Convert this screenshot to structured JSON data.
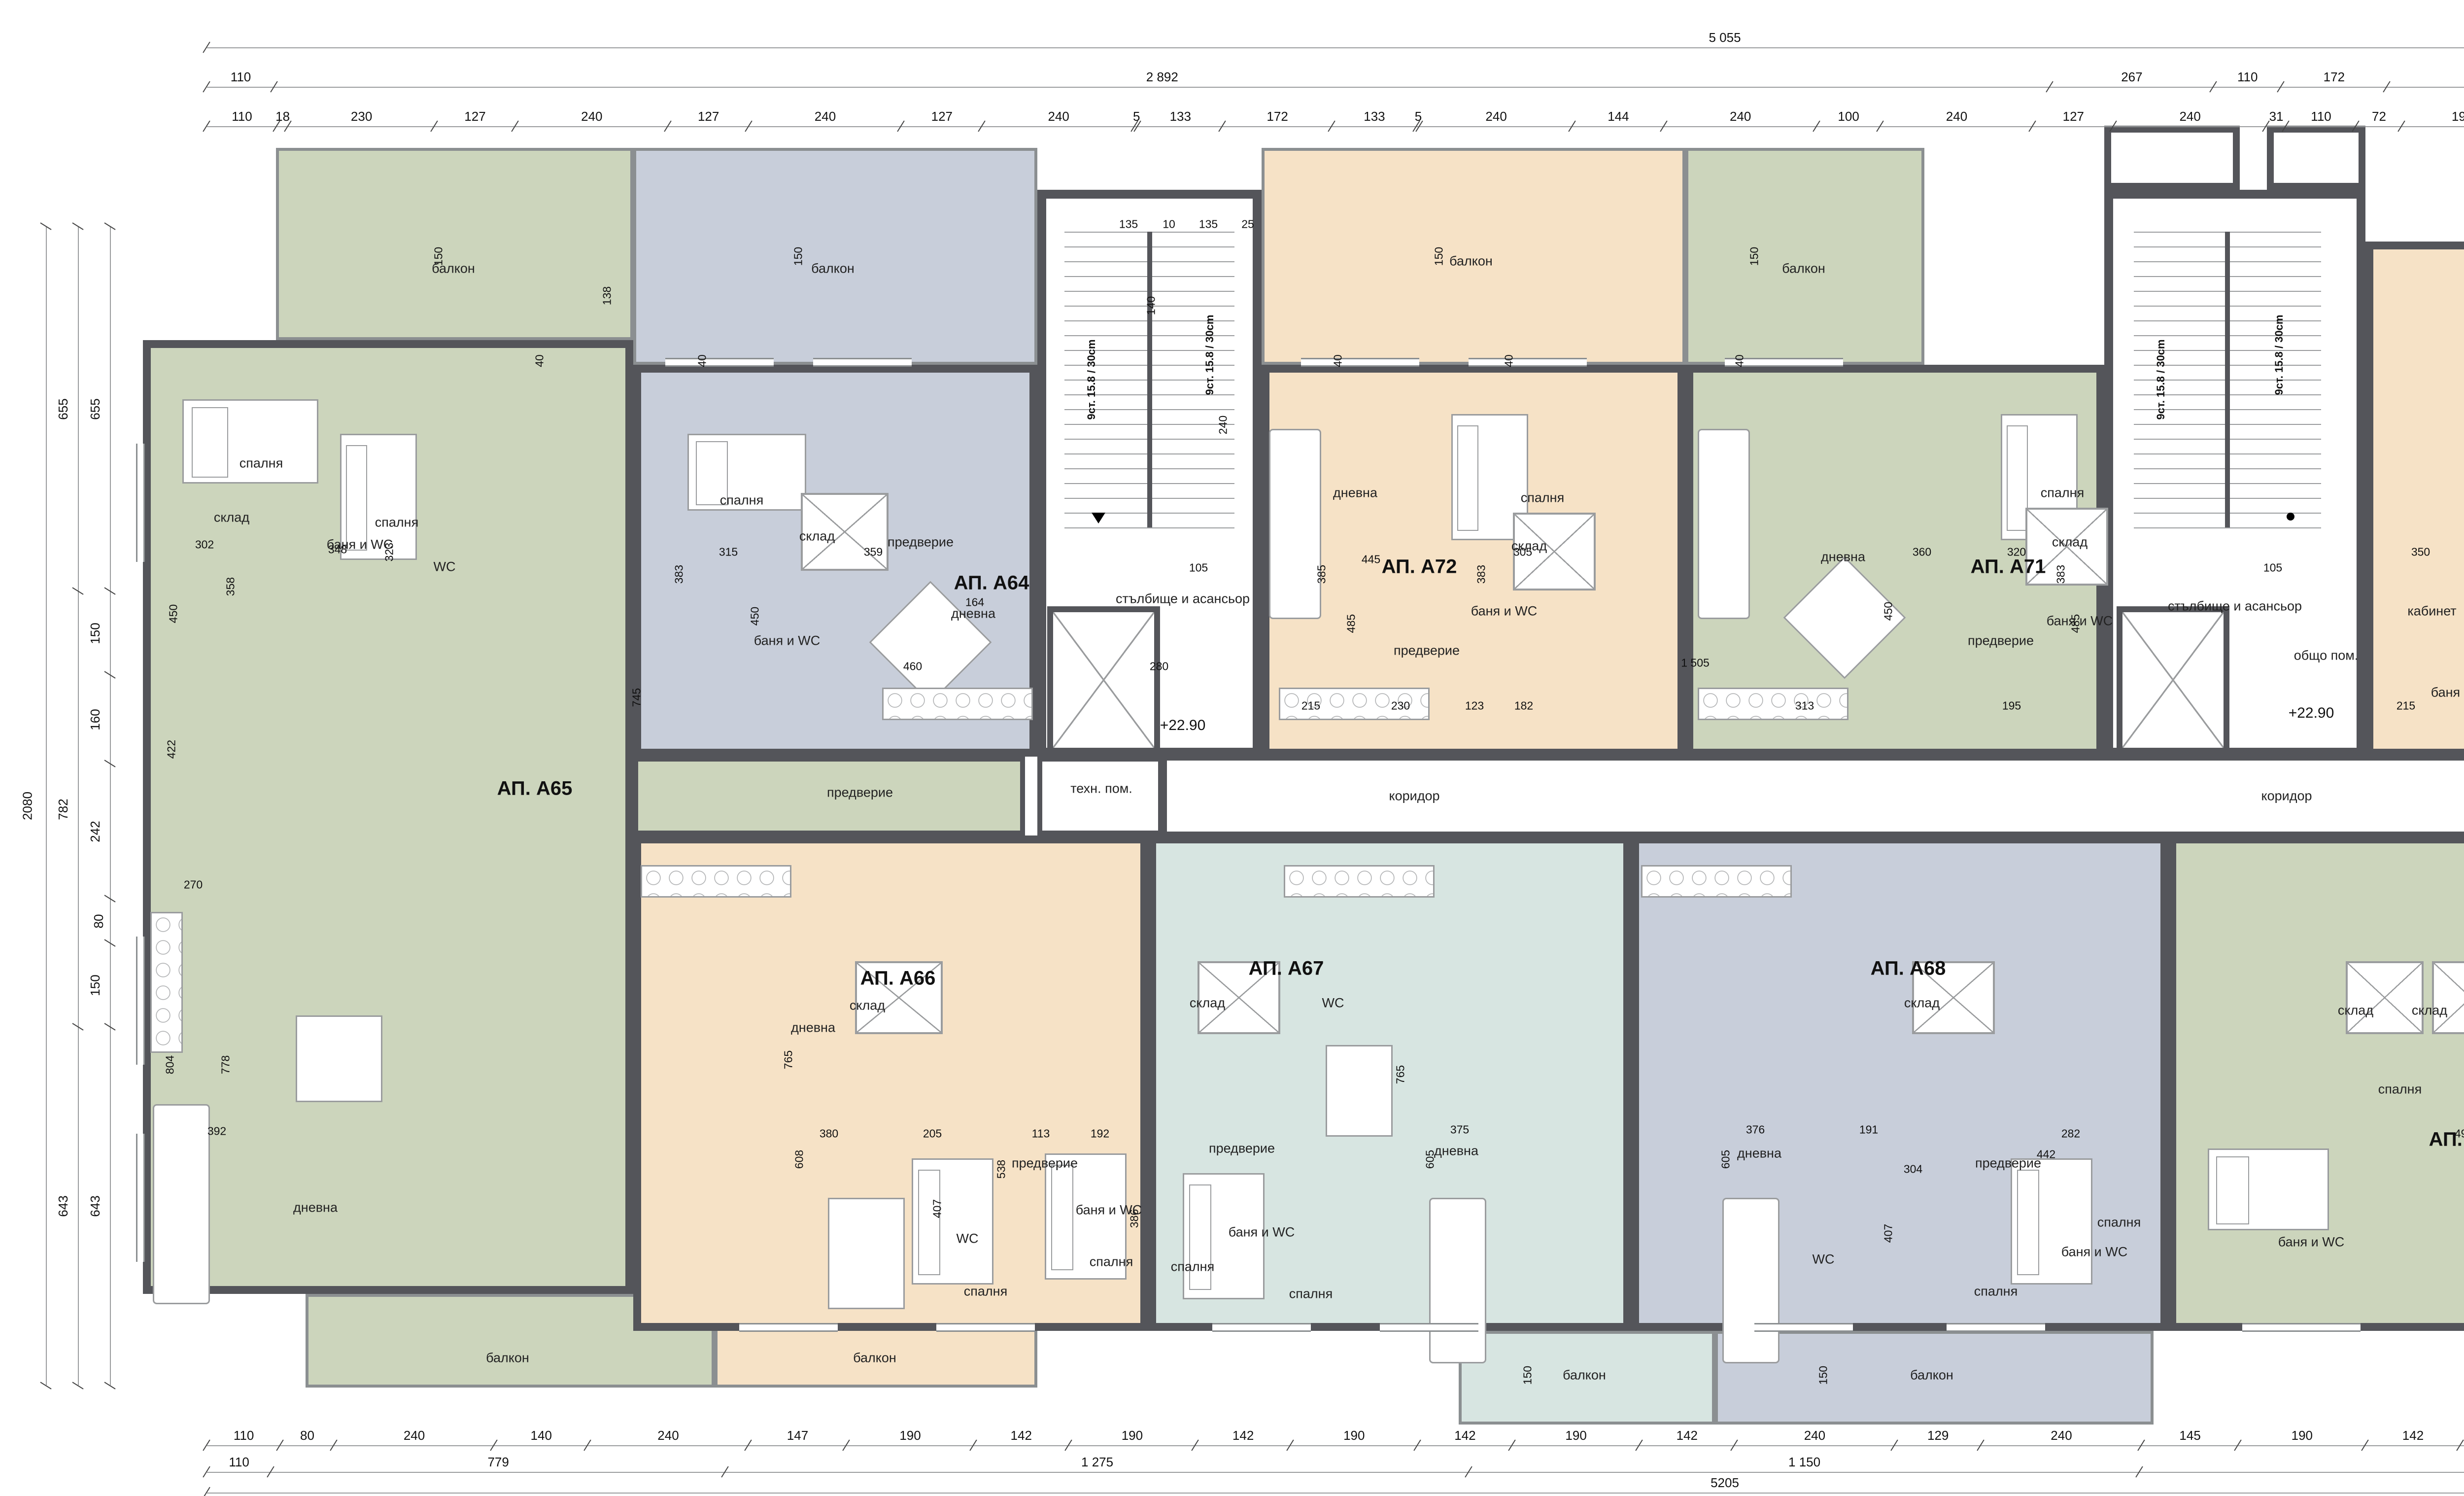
{
  "colors": {
    "wall": "#54555A",
    "wallLight": "#8B8F91",
    "line": "#9A9C9E",
    "green": "#CCD5BC",
    "blue": "#C8CEDA",
    "peach": "#F6E2C6",
    "teal": "#D7E5E1",
    "annex": "#E3E8D8",
    "north": "#2A1618",
    "text": "#111111"
  },
  "compass": {
    "letter": "N",
    "d1": "493",
    "d2": "493",
    "d3": "178"
  },
  "levels": [
    {
      "text": "+22.90"
    },
    {
      "text": "+22.90"
    }
  ],
  "stair_notes": [
    {
      "text": "9ст. 15.8 / 30cm"
    },
    {
      "text": "9ст. 15.8 / 30cm"
    },
    {
      "text": "9ст. 15.8 / 30cm"
    },
    {
      "text": "9ст. 15.8 / 30cm"
    }
  ],
  "apartments": [
    {
      "id": "A64",
      "label": "АП. А64",
      "color": "blue"
    },
    {
      "id": "A65",
      "label": "АП. А65",
      "color": "green"
    },
    {
      "id": "A66",
      "label": "АП. А66",
      "color": "peach"
    },
    {
      "id": "A67",
      "label": "АП. А67",
      "color": "teal"
    },
    {
      "id": "A68",
      "label": "АП. А68",
      "color": "blue"
    },
    {
      "id": "A69",
      "label": "АП. А69",
      "color": "green"
    },
    {
      "id": "A70",
      "label": "АП. А70",
      "color": "peach"
    },
    {
      "id": "A71",
      "label": "АП. А71",
      "color": "green"
    },
    {
      "id": "A72",
      "label": "АП. А72",
      "color": "peach"
    }
  ],
  "room_labels": [
    {
      "text": "балкон"
    },
    {
      "text": "балкон"
    },
    {
      "text": "балкон"
    },
    {
      "text": "балкон"
    },
    {
      "text": "балкон"
    },
    {
      "text": "балкон"
    },
    {
      "text": "балкон"
    },
    {
      "text": "балкон"
    },
    {
      "text": "балкон"
    },
    {
      "text": "балкон"
    },
    {
      "text": "спалня"
    },
    {
      "text": "спалня"
    },
    {
      "text": "спалня"
    },
    {
      "text": "спалня"
    },
    {
      "text": "спалня"
    },
    {
      "text": "спалня"
    },
    {
      "text": "спалня"
    },
    {
      "text": "спалня"
    },
    {
      "text": "спалня"
    },
    {
      "text": "спалня"
    },
    {
      "text": "спалня"
    },
    {
      "text": "спалня"
    },
    {
      "text": "спалня"
    },
    {
      "text": "спалня"
    },
    {
      "text": "спалня"
    },
    {
      "text": "дневна"
    },
    {
      "text": "дневна"
    },
    {
      "text": "дневна"
    },
    {
      "text": "дневна"
    },
    {
      "text": "дневна"
    },
    {
      "text": "дневна"
    },
    {
      "text": "дневна"
    },
    {
      "text": "дневна"
    },
    {
      "text": "дневна"
    },
    {
      "text": "предверие"
    },
    {
      "text": "предверие"
    },
    {
      "text": "предверие"
    },
    {
      "text": "предверие"
    },
    {
      "text": "предверие"
    },
    {
      "text": "предверие"
    },
    {
      "text": "предверие"
    },
    {
      "text": "предверие"
    },
    {
      "text": "предверие"
    },
    {
      "text": "баня и WC"
    },
    {
      "text": "баня и WC"
    },
    {
      "text": "баня и WC"
    },
    {
      "text": "баня и WC"
    },
    {
      "text": "баня и WC"
    },
    {
      "text": "баня и WC"
    },
    {
      "text": "баня и WC"
    },
    {
      "text": "баня и WC"
    },
    {
      "text": "баня и WC"
    },
    {
      "text": "баня и WC"
    },
    {
      "text": "WC"
    },
    {
      "text": "WC"
    },
    {
      "text": "WC"
    },
    {
      "text": "WC"
    },
    {
      "text": "склад"
    },
    {
      "text": "склад"
    },
    {
      "text": "склад"
    },
    {
      "text": "склад"
    },
    {
      "text": "склад"
    },
    {
      "text": "склад"
    },
    {
      "text": "склад"
    },
    {
      "text": "склад"
    },
    {
      "text": "склад"
    },
    {
      "text": "склад"
    },
    {
      "text": "кабинет"
    },
    {
      "text": "мокро пом."
    },
    {
      "text": "общо пом."
    },
    {
      "text": "техн. пом."
    },
    {
      "text": "стълбище и асансьор"
    },
    {
      "text": "стълбище и асансьор"
    },
    {
      "text": "коридор"
    },
    {
      "text": "коридор"
    }
  ],
  "inline_dims": [
    {
      "text": "302"
    },
    {
      "text": "358"
    },
    {
      "text": "450"
    },
    {
      "text": "348"
    },
    {
      "text": "323"
    },
    {
      "text": "422"
    },
    {
      "text": "270"
    },
    {
      "text": "392"
    },
    {
      "text": "778"
    },
    {
      "text": "804"
    },
    {
      "text": "315"
    },
    {
      "text": "383"
    },
    {
      "text": "450"
    },
    {
      "text": "359"
    },
    {
      "text": "745"
    },
    {
      "text": "164"
    },
    {
      "text": "460"
    },
    {
      "text": "280"
    },
    {
      "text": "1 505"
    },
    {
      "text": "445"
    },
    {
      "text": "385"
    },
    {
      "text": "485"
    },
    {
      "text": "305"
    },
    {
      "text": "383"
    },
    {
      "text": "215"
    },
    {
      "text": "230"
    },
    {
      "text": "123"
    },
    {
      "text": "182"
    },
    {
      "text": "360"
    },
    {
      "text": "450"
    },
    {
      "text": "313"
    },
    {
      "text": "320"
    },
    {
      "text": "383"
    },
    {
      "text": "485"
    },
    {
      "text": "195"
    },
    {
      "text": "350"
    },
    {
      "text": "305"
    },
    {
      "text": "328"
    },
    {
      "text": "305"
    },
    {
      "text": "370"
    },
    {
      "text": "376"
    },
    {
      "text": "600"
    },
    {
      "text": "215"
    },
    {
      "text": "192"
    },
    {
      "text": "488"
    },
    {
      "text": "138"
    },
    {
      "text": "493"
    },
    {
      "text": "305"
    },
    {
      "text": "334"
    },
    {
      "text": "250"
    },
    {
      "text": "388"
    },
    {
      "text": "726"
    },
    {
      "text": "368"
    },
    {
      "text": "358"
    },
    {
      "text": "380"
    },
    {
      "text": "608"
    },
    {
      "text": "765"
    },
    {
      "text": "205"
    },
    {
      "text": "407"
    },
    {
      "text": "538"
    },
    {
      "text": "113"
    },
    {
      "text": "192"
    },
    {
      "text": "386"
    },
    {
      "text": "375"
    },
    {
      "text": "605"
    },
    {
      "text": "765"
    },
    {
      "text": "376"
    },
    {
      "text": "605"
    },
    {
      "text": "191"
    },
    {
      "text": "282"
    },
    {
      "text": "442"
    },
    {
      "text": "304"
    },
    {
      "text": "407"
    },
    {
      "text": "150"
    },
    {
      "text": "150"
    },
    {
      "text": "150"
    },
    {
      "text": "150"
    },
    {
      "text": "138"
    },
    {
      "text": "150"
    },
    {
      "text": "150"
    },
    {
      "text": "240"
    },
    {
      "text": "140"
    },
    {
      "text": "105"
    },
    {
      "text": "105"
    },
    {
      "text": "135"
    },
    {
      "text": "10"
    },
    {
      "text": "135"
    },
    {
      "text": "25"
    },
    {
      "text": "40"
    },
    {
      "text": "40"
    },
    {
      "text": "40"
    },
    {
      "text": "40"
    },
    {
      "text": "40"
    },
    {
      "text": "40"
    }
  ],
  "dims": {
    "top_row1": [
      {
        "text": "5 055"
      }
    ],
    "top_row2": [
      {
        "text": "110"
      },
      {
        "text": "2 892"
      },
      {
        "text": "267"
      },
      {
        "text": "110"
      },
      {
        "text": "172"
      },
      {
        "text": "1 394"
      }
    ],
    "top_row3": [
      {
        "text": "110"
      },
      {
        "text": "18"
      },
      {
        "text": "230"
      },
      {
        "text": "127"
      },
      {
        "text": "240"
      },
      {
        "text": "127"
      },
      {
        "text": "240"
      },
      {
        "text": "127"
      },
      {
        "text": "240"
      },
      {
        "text": "5"
      },
      {
        "text": "133"
      },
      {
        "text": "172"
      },
      {
        "text": "133"
      },
      {
        "text": "5"
      },
      {
        "text": "240"
      },
      {
        "text": "144"
      },
      {
        "text": "240"
      },
      {
        "text": "100"
      },
      {
        "text": "240"
      },
      {
        "text": "127"
      },
      {
        "text": "240"
      },
      {
        "text": "31"
      },
      {
        "text": "110"
      },
      {
        "text": "72"
      },
      {
        "text": "190"
      },
      {
        "text": "128"
      },
      {
        "text": "190"
      },
      {
        "text": "129"
      },
      {
        "text": "190"
      },
      {
        "text": "127"
      },
      {
        "text": "190"
      },
      {
        "text": "178"
      }
    ],
    "bottom_row1": [
      {
        "text": "110"
      },
      {
        "text": "80"
      },
      {
        "text": "240"
      },
      {
        "text": "140"
      },
      {
        "text": "240"
      },
      {
        "text": "147"
      },
      {
        "text": "190"
      },
      {
        "text": "142"
      },
      {
        "text": "190"
      },
      {
        "text": "142"
      },
      {
        "text": "190"
      },
      {
        "text": "142"
      },
      {
        "text": "190"
      },
      {
        "text": "142"
      },
      {
        "text": "240"
      },
      {
        "text": "129"
      },
      {
        "text": "240"
      },
      {
        "text": "145"
      },
      {
        "text": "190"
      },
      {
        "text": "142"
      },
      {
        "text": "190"
      },
      {
        "text": "142"
      },
      {
        "text": "190"
      },
      {
        "text": "65"
      },
      {
        "text": "583"
      }
    ],
    "bottom_row2": [
      {
        "text": "110"
      },
      {
        "text": "779"
      },
      {
        "text": "1 275"
      },
      {
        "text": "1 150"
      },
      {
        "text": "1 308"
      },
      {
        "text": "583"
      }
    ],
    "bottom_row3": [
      {
        "text": "5205"
      }
    ],
    "left_outer": [
      {
        "text": "2080"
      }
    ],
    "left_mid": [
      {
        "text": "655"
      },
      {
        "text": "782"
      },
      {
        "text": "643"
      }
    ],
    "left_inner": [
      {
        "text": "655"
      },
      {
        "text": "150"
      },
      {
        "text": "160"
      },
      {
        "text": "242"
      },
      {
        "text": "80"
      },
      {
        "text": "150"
      },
      {
        "text": "643"
      }
    ],
    "right_outer": [
      {
        "text": "1 865"
      }
    ],
    "right_mid": [
      {
        "text": "398"
      },
      {
        "text": "110"
      },
      {
        "text": "1 061"
      },
      {
        "text": "186"
      },
      {
        "text": "110"
      }
    ],
    "right_inner": [
      {
        "text": "212"
      },
      {
        "text": "190"
      },
      {
        "text": "140"
      },
      {
        "text": "80"
      },
      {
        "text": "268"
      },
      {
        "text": "190"
      },
      {
        "text": "205"
      },
      {
        "text": "140"
      },
      {
        "text": "140"
      },
      {
        "text": "190"
      },
      {
        "text": "110"
      }
    ]
  }
}
